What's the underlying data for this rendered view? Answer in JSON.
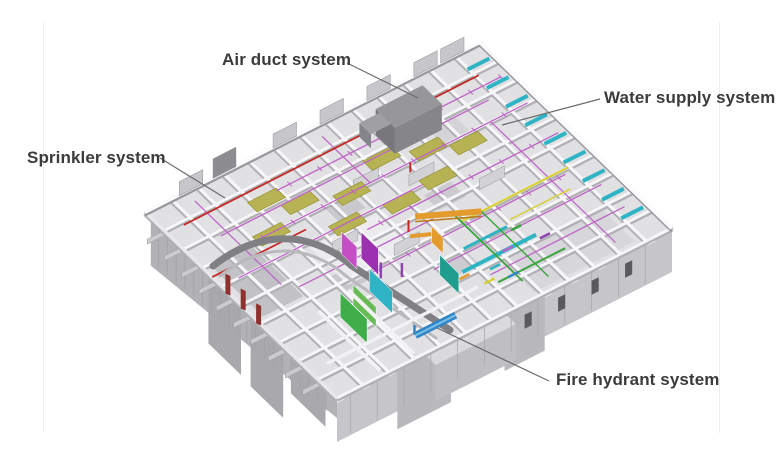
{
  "annotations": [
    {
      "id": "air-duct",
      "label": "Air duct system",
      "system_color": "#b7b354"
    },
    {
      "id": "water-supply",
      "label": "Water supply system",
      "system_color": "#bd62c6"
    },
    {
      "id": "sprinkler",
      "label": "Sprinkler system",
      "system_color": "#c22a26"
    },
    {
      "id": "fire-hydrant",
      "label": "Fire hydrant system",
      "system_color": "#2f86c8"
    }
  ],
  "colors": {
    "background": "#ffffff",
    "label_text": "#3b3b3e",
    "leader_line": "#6b6b6b",
    "structure_light": "#f7f7f9",
    "structure_mid": "#c6c6ca",
    "structure_dark": "#8d8d91",
    "pipe_cyan": "#2fb4c6",
    "pipe_green": "#3aa43e",
    "pipe_yellow": "#d9cf35",
    "pipe_orange": "#e39b2d",
    "pipe_purple": "#8e44ad"
  }
}
